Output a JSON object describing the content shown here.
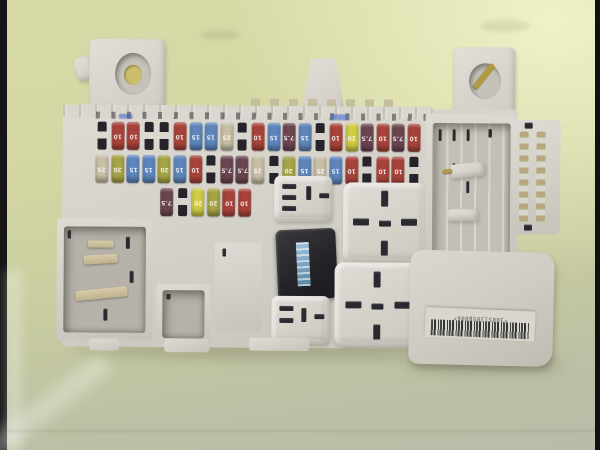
{
  "scene": {
    "subject": "automotive fuse box module on pale green surface",
    "background_top_color": "#d7daa5",
    "background_bottom_color": "#b9bca8",
    "side_bar_color": "#141414"
  },
  "unit": {
    "plastic_color": "#d5d2ca",
    "cavity_color": "#b6b2a9",
    "relay_body_color": "#28282c",
    "relay_label_color": "#7fa9c9",
    "brass_clip_color": "#b29a41",
    "ink_mark_color": "#3e60cd"
  },
  "barcode": {
    "text": "*30851305B806*"
  },
  "fuses": {
    "colors": {
      "red": "#a8433b",
      "blue": "#5e86bd",
      "yellow": "#cfcc45",
      "olive": "#a6a546",
      "tan": "#c8bfa6",
      "maroon": "#6b4550"
    },
    "amps": {
      "red": "10",
      "blue": "15",
      "yellow": "20",
      "olive": "20",
      "tan": "25",
      "maroon": "7.5"
    },
    "rows": [
      {
        "slots": [
          "empty",
          "red",
          "red",
          "empty",
          "empty",
          "red",
          "blue",
          "blue",
          "tan",
          "empty",
          "red",
          "blue",
          "maroon",
          "blue",
          "empty",
          "red",
          "yellow",
          "maroon",
          "red",
          "maroon",
          "red"
        ]
      },
      {
        "slots": [
          "tan",
          "olive",
          "blue",
          "blue",
          "olive",
          "blue",
          "red",
          "empty",
          "maroon",
          "maroon",
          "tan",
          "empty",
          "olive",
          "blue",
          "tan",
          "blue",
          "red",
          "empty",
          "red",
          "red",
          "empty"
        ]
      },
      {
        "slots": [
          "maroon",
          "empty",
          "yellow",
          "olive",
          "red",
          "red"
        ]
      }
    ]
  }
}
